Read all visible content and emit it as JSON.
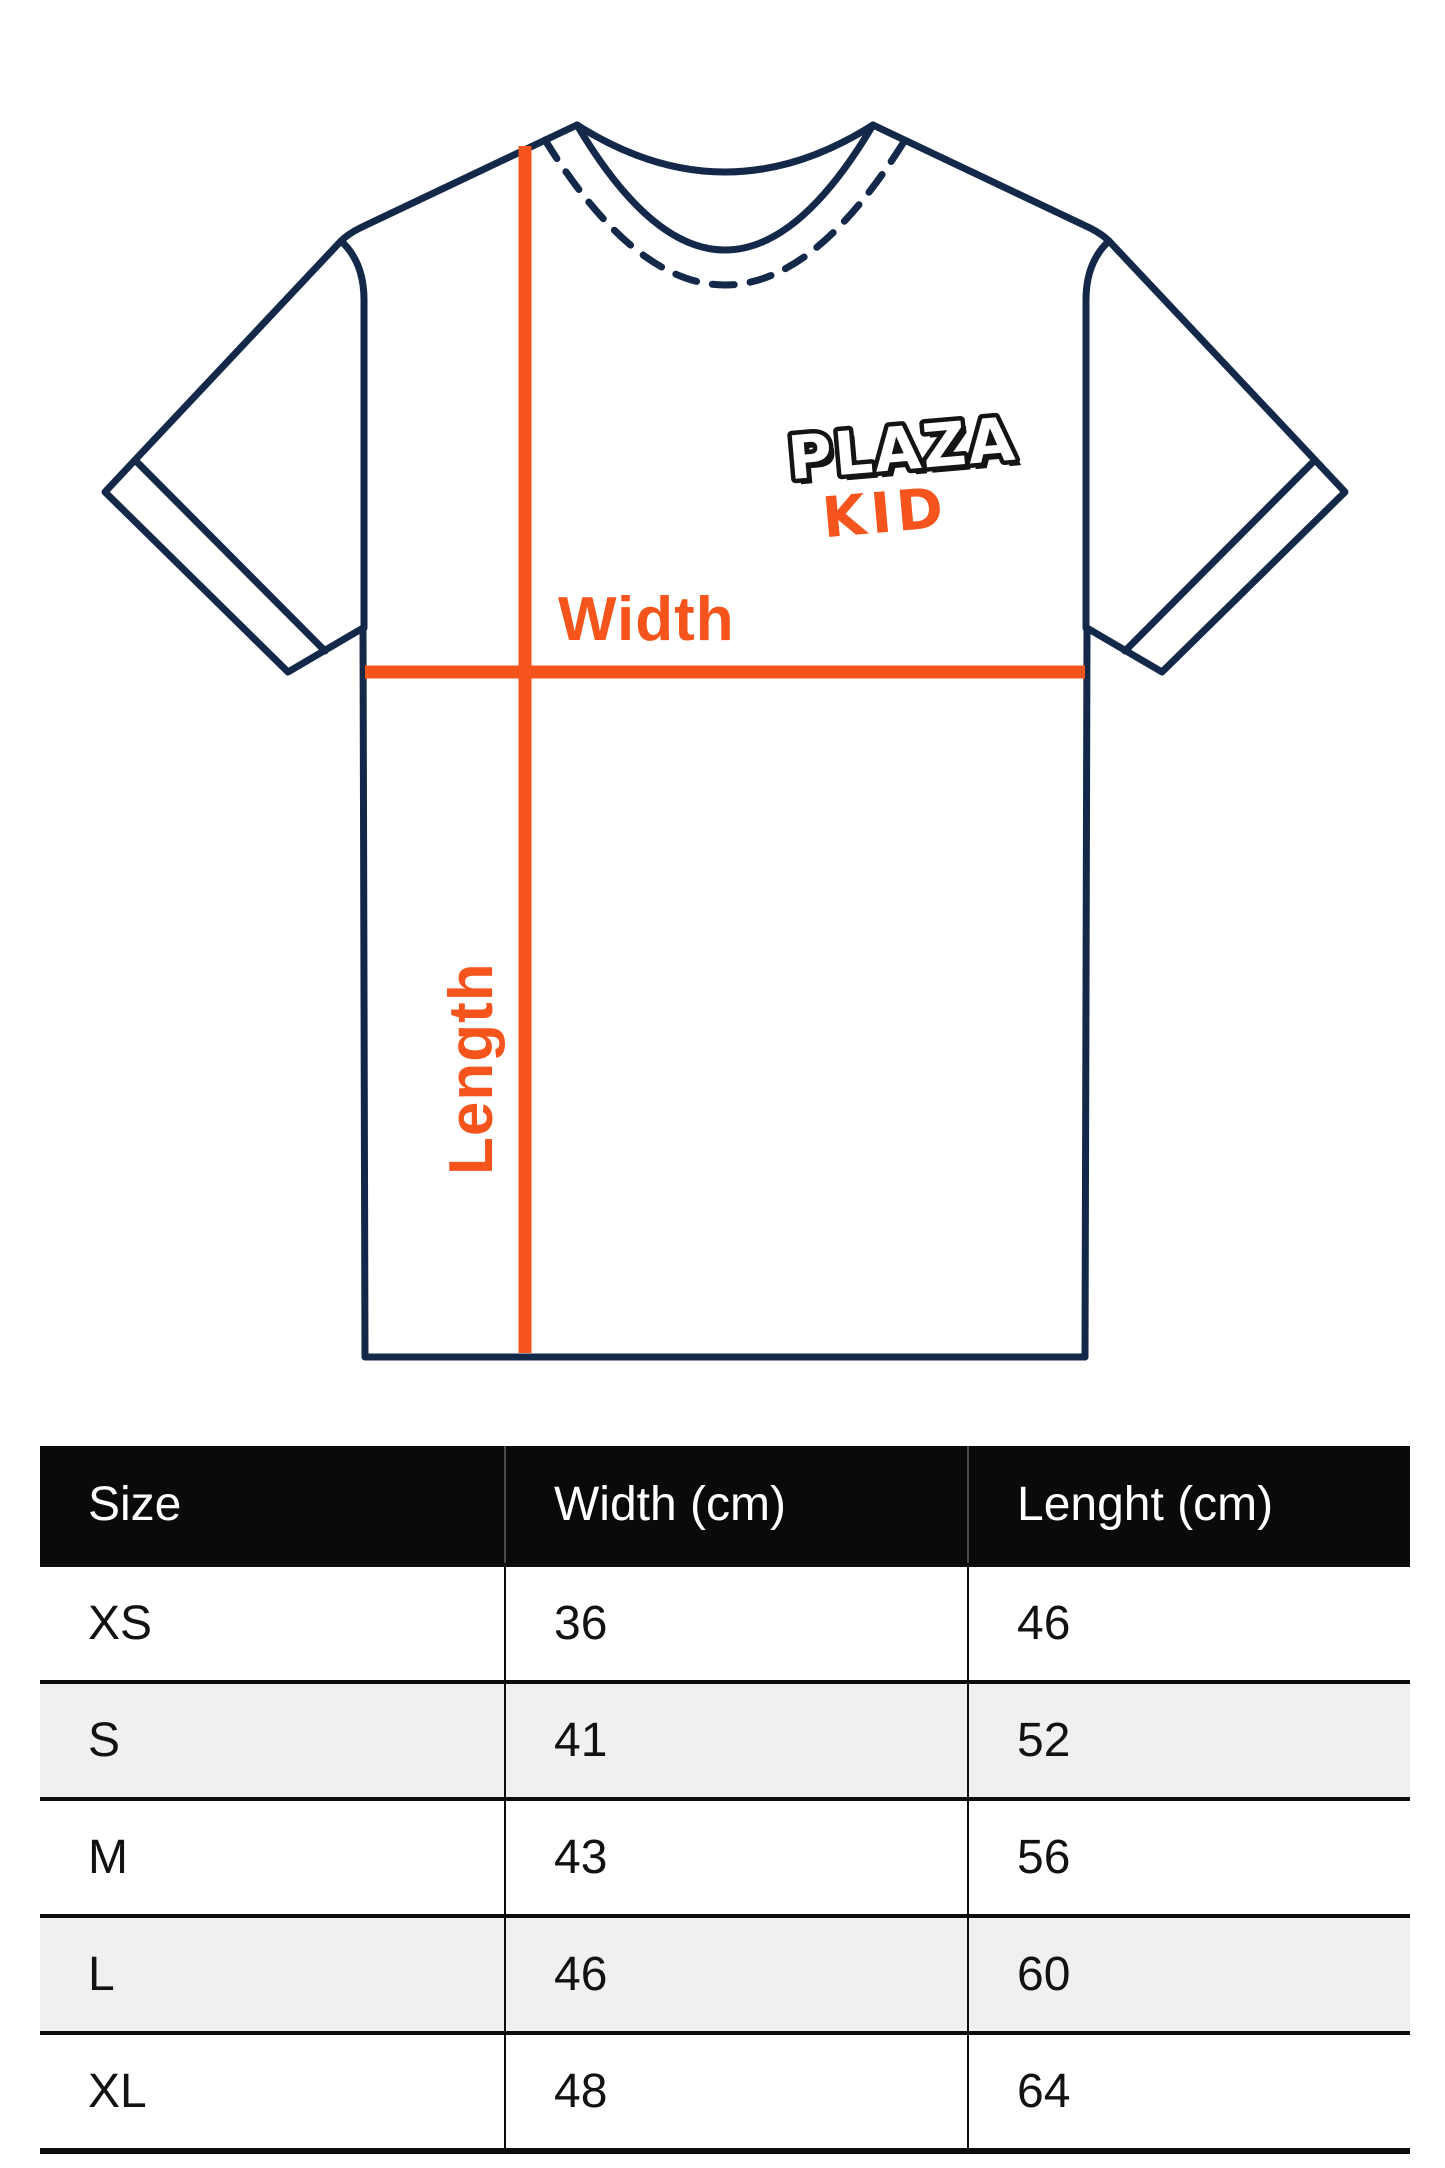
{
  "diagram": {
    "brand": {
      "line1": "PLAZA",
      "line2": "KID"
    },
    "labels": {
      "width": "Width",
      "length": "Length"
    },
    "colors": {
      "outline_navy": "#14294a",
      "accent_orange": "#f5541c",
      "logo_black": "#141414",
      "logo_white": "#ffffff"
    }
  },
  "size_table": {
    "columns": [
      "Size",
      "Width (cm)",
      "Lenght (cm)"
    ],
    "rows": [
      {
        "size": "XS",
        "width": "36",
        "length": "46"
      },
      {
        "size": "S",
        "width": "41",
        "length": "52"
      },
      {
        "size": "M",
        "width": "43",
        "length": "56"
      },
      {
        "size": "L",
        "width": "46",
        "length": "60"
      },
      {
        "size": "XL",
        "width": "48",
        "length": "64"
      }
    ],
    "header_bg": "#0a0a0a",
    "alt_row_bg": "#f0f0f0"
  },
  "chart_data": {
    "type": "table",
    "title": "T-shirt size chart",
    "columns": [
      "Size",
      "Width (cm)",
      "Lenght (cm)"
    ],
    "rows": [
      [
        "XS",
        36,
        46
      ],
      [
        "S",
        41,
        52
      ],
      [
        "M",
        43,
        56
      ],
      [
        "L",
        46,
        60
      ],
      [
        "XL",
        48,
        64
      ]
    ]
  }
}
